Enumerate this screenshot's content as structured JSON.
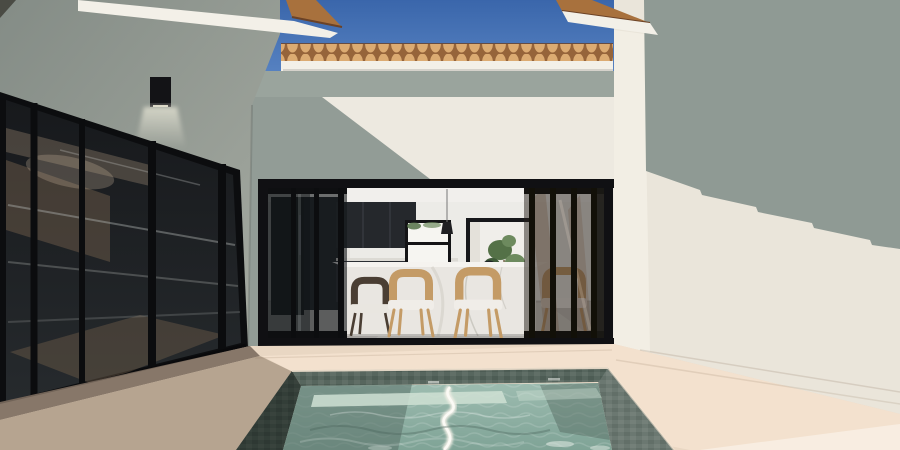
{
  "meta": {
    "type": "3d-architectural-rendering",
    "description": "Daytime exterior render of a modern courtyard: plunge pool with stone mosaic tiles in the foreground, timber-look deck, black-framed sliding glass walls on the left, and a central open sliding door revealing a kitchen-dining interior; terracotta barrel-tile rooflines against a blue sky."
  },
  "scene": {
    "objects": [
      "blue sky",
      "terracotta barrel-tile roofline",
      "white roof fascia",
      "courtyard wall with diagonal roof shadow",
      "left building shaded wall",
      "black cylindrical wall light with glow cone",
      "black-framed sliding glass door wall",
      "central opening with stacked sliding glass panels",
      "kitchen with dark cabinets and refrigerator",
      "bright back window with greenery",
      "rear doorway with potted plant",
      "white marble dining island",
      "tan timber dining chairs with white cushions",
      "pendant light",
      "right building sunlit wall with scalloped shadow",
      "timber deck",
      "plunge pool with mosaic tile walls",
      "submerged pool bench",
      "sun reflection streak on water"
    ]
  },
  "colors": {
    "sky_top": "#3a66ab",
    "sky_bottom": "#5d88c6",
    "roof_tile": "#dcab72",
    "roof_tile_shadow": "#96643a",
    "eave_tile": "#a8713d",
    "fascia": "#f3f0e8",
    "wall_sunlit": "#ede9e0",
    "wall_shaded": "#929c96",
    "wall_band": "#9aa49d",
    "left_wall": "#848c86",
    "left_wall_light": "#a6aba2",
    "frame_black": "#101013",
    "glass_top": "#17191c",
    "glass_bottom": "#262a2d",
    "glass_reflection_warm": "#6e5c4a",
    "interior_ceiling": "#f1efec",
    "interior_wall": "#ecebe7",
    "interior_floor": "#c8c5c0",
    "cabinet_dark": "#25282c",
    "refrigerator": "#1b1e22",
    "counter_top": "#dcdad4",
    "marble": "#e9e6e1",
    "marble_top": "#f5f3ef",
    "chair_wood": "#c49b66",
    "chair_dark": "#4a3e33",
    "cushion_white": "#f0ede8",
    "window_light": "#f6f5f1",
    "plant_green": "#547147",
    "plant_green_light": "#6d8a5e",
    "pendant_black": "#1f1f22",
    "right_wall_sun": "#eae5da",
    "right_wall_corner": "#f2eee4",
    "right_wall_shadow": "#8f9a94",
    "deck": "#e9d7c3",
    "deck_sunlit": "#f3e1ce",
    "deck_shadow": "#7c6d5f",
    "deck_midshadow": "#b3a18d",
    "deck_bright": "#f8ede1",
    "pool_tile": "#57665e",
    "pool_tile_a": "#4d5c54",
    "pool_tile_b": "#616f67",
    "water_top": "#9dbcb0",
    "water_bottom": "#7fa396",
    "water_shadow": "#5d756c",
    "pool_bench": "#cfe0d4",
    "sun_streak": "#f4f1e8",
    "light_glow": "#f6f3e2",
    "light_fixture": "#131316"
  }
}
